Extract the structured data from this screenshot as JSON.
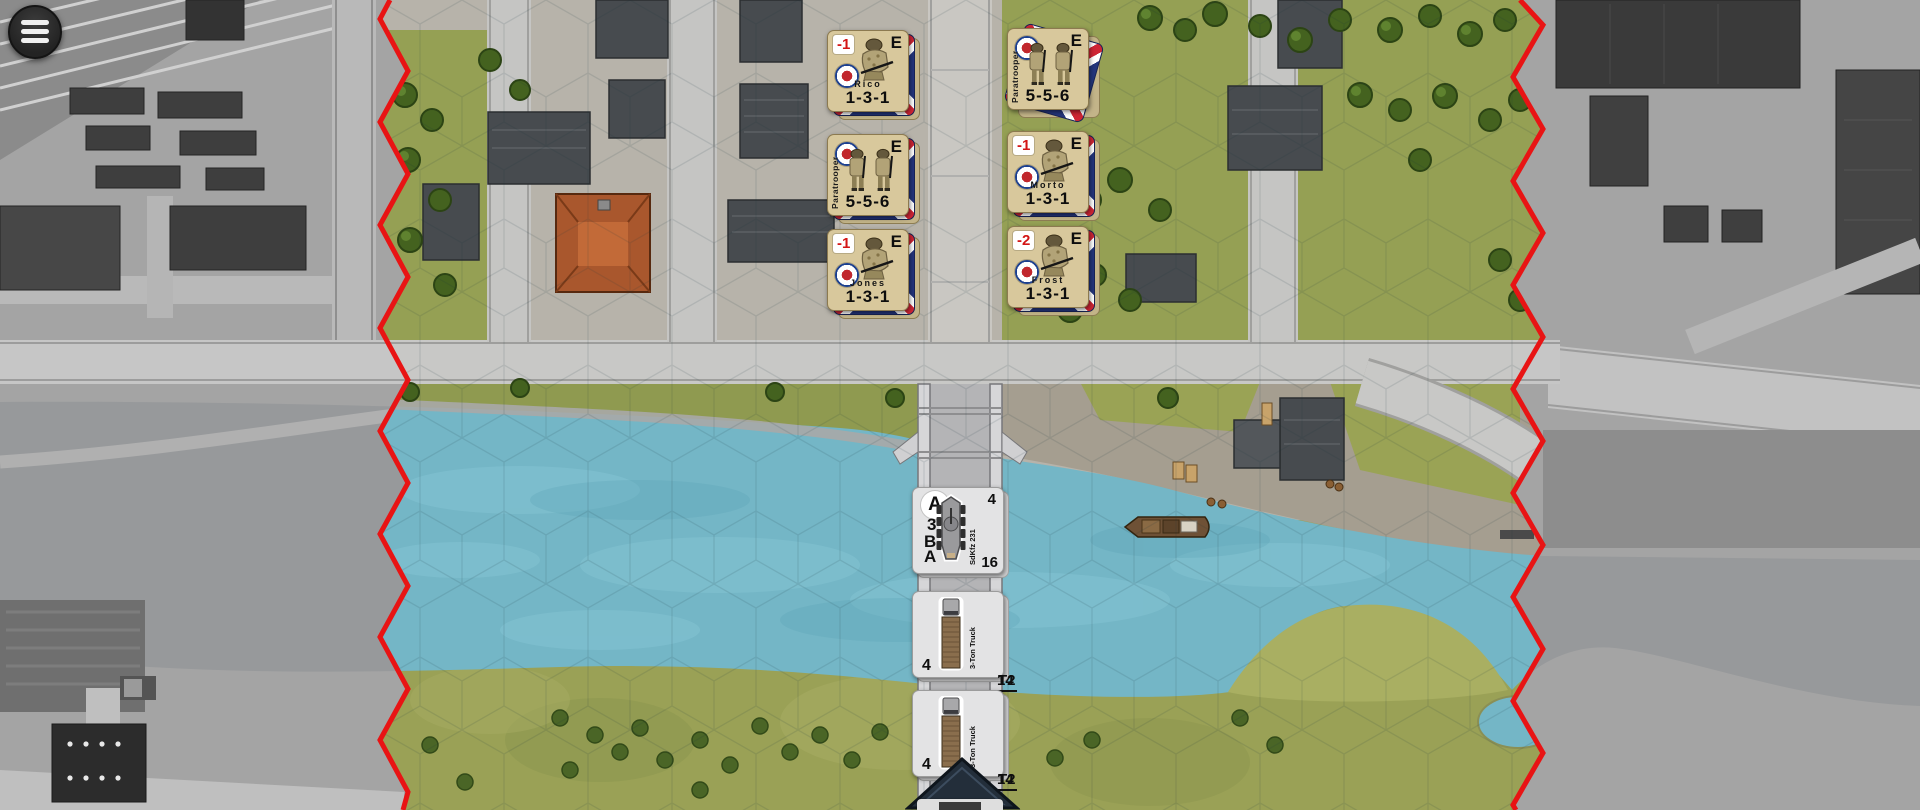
{
  "menu_button": {
    "icon": "hamburger-menu-icon"
  },
  "map": {
    "colors": {
      "boundary_red": "#e81414",
      "water_blue": "#74b6c6",
      "british_counter_tan": "#d8c89c",
      "german_counter_gray": "#e3e3e4",
      "modifier_red": "#d31616"
    }
  },
  "counters": {
    "british": [
      {
        "name": "Rico",
        "strength": "1-3-1",
        "modifier": "-1",
        "elite": "E"
      },
      {
        "label": "Paratrooper",
        "strength": "5-5-6",
        "modifier": "",
        "elite": "E"
      },
      {
        "name": "Jones",
        "strength": "1-3-1",
        "modifier": "-1",
        "elite": "E"
      },
      {
        "label": "Paratrooper",
        "strength": "5-5-6",
        "modifier": "",
        "elite": "E"
      },
      {
        "name": "Morto",
        "strength": "1-3-1",
        "modifier": "-1",
        "elite": "E"
      },
      {
        "name": "Frost",
        "strength": "1-3-1",
        "modifier": "-2",
        "elite": "E"
      }
    ],
    "german_vehicles": [
      {
        "label": "SdKfz 231",
        "circle": "A",
        "left_value": "3",
        "bottom_left_top": "B",
        "bottom_left_bottom": "A",
        "top_right": "4",
        "bottom_right": "16"
      },
      {
        "label": "3-Ton Truck",
        "left_value": "4",
        "code": "T2",
        "value": "14"
      },
      {
        "label": "3-Ton Truck",
        "left_value": "4",
        "code": "T2",
        "value": "14"
      }
    ]
  }
}
